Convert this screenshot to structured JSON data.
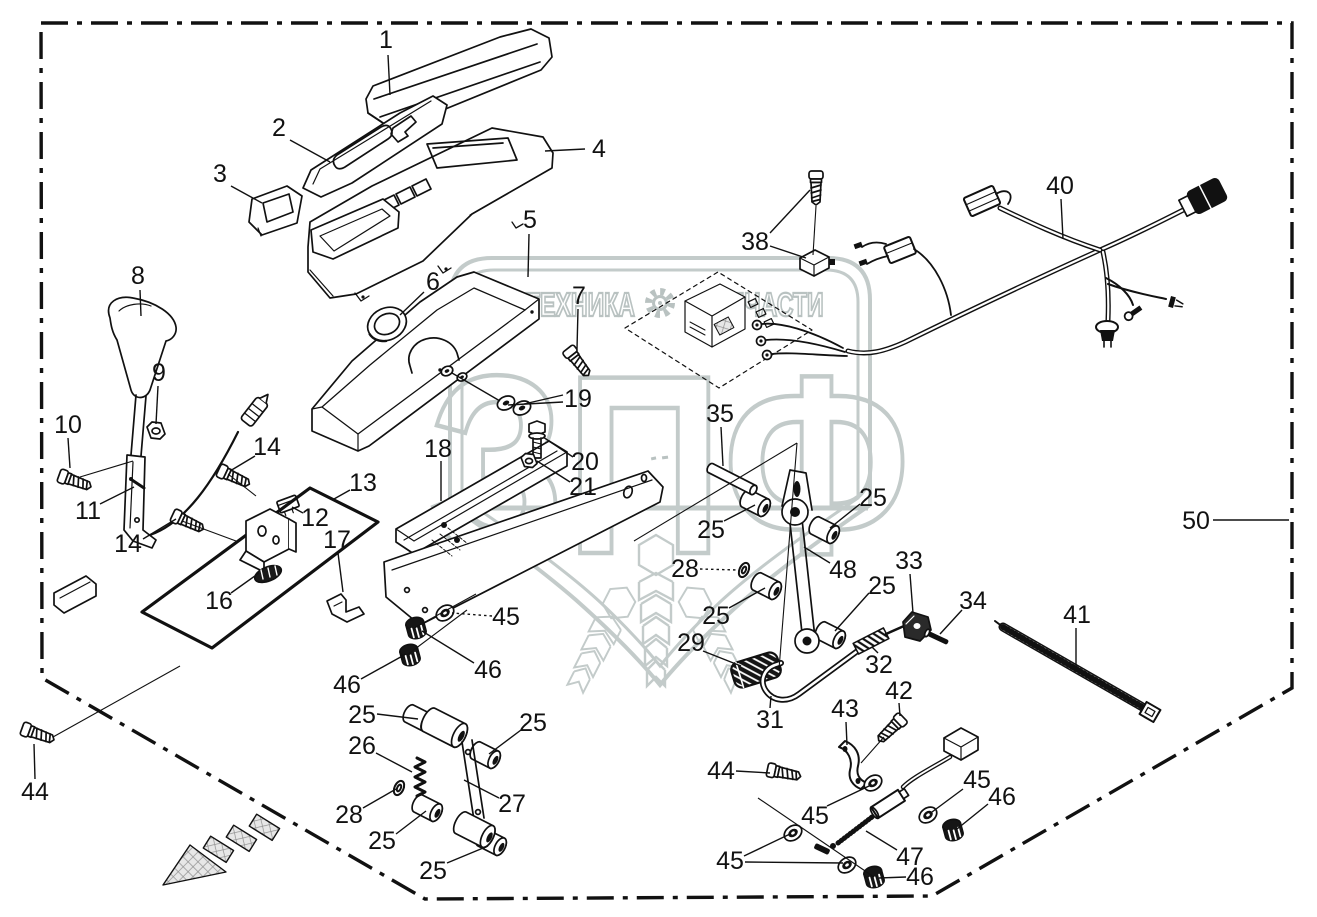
{
  "watermark": {
    "brand_left": "ТЕХНИКА",
    "brand_right": "ЗАПЧАСТИ",
    "logo_letters": "ЗПФ",
    "color": "#c3cbca"
  },
  "frame": {
    "assembly_label": "50"
  },
  "colors": {
    "line": "#111111",
    "background": "#ffffff",
    "watermark": "#c3cbca"
  },
  "callouts": [
    {
      "t": "1",
      "x": 386,
      "y": 40
    },
    {
      "t": "2",
      "x": 279,
      "y": 128
    },
    {
      "t": "3",
      "x": 220,
      "y": 174
    },
    {
      "t": "4",
      "x": 599,
      "y": 149
    },
    {
      "t": "5",
      "x": 530,
      "y": 220
    },
    {
      "t": "6",
      "x": 433,
      "y": 282
    },
    {
      "t": "7",
      "x": 579,
      "y": 296
    },
    {
      "t": "8",
      "x": 138,
      "y": 276
    },
    {
      "t": "9",
      "x": 159,
      "y": 373
    },
    {
      "t": "10",
      "x": 68,
      "y": 425
    },
    {
      "t": "11",
      "x": 88,
      "y": 511
    },
    {
      "t": "12",
      "x": 315,
      "y": 518
    },
    {
      "t": "13",
      "x": 363,
      "y": 483
    },
    {
      "t": "14",
      "x": 267,
      "y": 447
    },
    {
      "t": "14",
      "x": 128,
      "y": 544
    },
    {
      "t": "16",
      "x": 219,
      "y": 601
    },
    {
      "t": "17",
      "x": 337,
      "y": 540
    },
    {
      "t": "18",
      "x": 438,
      "y": 449
    },
    {
      "t": "19",
      "x": 578,
      "y": 399
    },
    {
      "t": "20",
      "x": 585,
      "y": 462
    },
    {
      "t": "21",
      "x": 583,
      "y": 487
    },
    {
      "t": "25",
      "x": 711,
      "y": 530
    },
    {
      "t": "25",
      "x": 873,
      "y": 498
    },
    {
      "t": "25",
      "x": 716,
      "y": 616
    },
    {
      "t": "25",
      "x": 882,
      "y": 586
    },
    {
      "t": "25",
      "x": 362,
      "y": 715
    },
    {
      "t": "25",
      "x": 533,
      "y": 723
    },
    {
      "t": "25",
      "x": 382,
      "y": 841
    },
    {
      "t": "25",
      "x": 433,
      "y": 871
    },
    {
      "t": "26",
      "x": 362,
      "y": 746
    },
    {
      "t": "27",
      "x": 512,
      "y": 804
    },
    {
      "t": "28",
      "x": 685,
      "y": 569
    },
    {
      "t": "28",
      "x": 349,
      "y": 815
    },
    {
      "t": "29",
      "x": 691,
      "y": 643
    },
    {
      "t": "31",
      "x": 770,
      "y": 720
    },
    {
      "t": "32",
      "x": 879,
      "y": 665
    },
    {
      "t": "33",
      "x": 909,
      "y": 561
    },
    {
      "t": "34",
      "x": 973,
      "y": 601
    },
    {
      "t": "35",
      "x": 720,
      "y": 414
    },
    {
      "t": "38",
      "x": 755,
      "y": 242
    },
    {
      "t": "40",
      "x": 1060,
      "y": 186
    },
    {
      "t": "41",
      "x": 1077,
      "y": 615
    },
    {
      "t": "42",
      "x": 899,
      "y": 691
    },
    {
      "t": "43",
      "x": 845,
      "y": 709
    },
    {
      "t": "44",
      "x": 35,
      "y": 792
    },
    {
      "t": "44",
      "x": 721,
      "y": 771
    },
    {
      "t": "45",
      "x": 506,
      "y": 617
    },
    {
      "t": "45",
      "x": 815,
      "y": 816
    },
    {
      "t": "45",
      "x": 977,
      "y": 780
    },
    {
      "t": "45",
      "x": 730,
      "y": 861
    },
    {
      "t": "46",
      "x": 488,
      "y": 670
    },
    {
      "t": "46",
      "x": 347,
      "y": 685
    },
    {
      "t": "46",
      "x": 1002,
      "y": 797
    },
    {
      "t": "46",
      "x": 920,
      "y": 877
    },
    {
      "t": "47",
      "x": 910,
      "y": 857
    },
    {
      "t": "48",
      "x": 843,
      "y": 570
    },
    {
      "t": "50",
      "x": 1196,
      "y": 521
    }
  ],
  "leader_lines": [
    {
      "p": [
        [
          388,
          55
        ],
        [
          390,
          95
        ]
      ]
    },
    {
      "p": [
        [
          290,
          140
        ],
        [
          330,
          162
        ]
      ]
    },
    {
      "p": [
        [
          231,
          186
        ],
        [
          262,
          203
        ]
      ]
    },
    {
      "p": [
        [
          585,
          149
        ],
        [
          545,
          151
        ]
      ]
    },
    {
      "p": [
        [
          529,
          234
        ],
        [
          528,
          277
        ]
      ]
    },
    {
      "p": [
        [
          424,
          292
        ],
        [
          400,
          315
        ]
      ]
    },
    {
      "p": [
        [
          578,
          309
        ],
        [
          577,
          349
        ]
      ]
    },
    {
      "p": [
        [
          140,
          290
        ],
        [
          141,
          316
        ]
      ]
    },
    {
      "p": [
        [
          158,
          386
        ],
        [
          156,
          424
        ]
      ]
    },
    {
      "p": [
        [
          68,
          438
        ],
        [
          70,
          468
        ]
      ]
    },
    {
      "p": [
        [
          100,
          504
        ],
        [
          134,
          487
        ]
      ]
    },
    {
      "p": [
        [
          255,
          456
        ],
        [
          230,
          471
        ]
      ]
    },
    {
      "p": [
        [
          143,
          539
        ],
        [
          176,
          519
        ]
      ]
    },
    {
      "p": [
        [
          303,
          513
        ],
        [
          292,
          507
        ]
      ]
    },
    {
      "p": [
        [
          350,
          490
        ],
        [
          334,
          499
        ]
      ]
    },
    {
      "p": [
        [
          231,
          593
        ],
        [
          259,
          573
        ]
      ]
    },
    {
      "p": [
        [
          338,
          553
        ],
        [
          343,
          592
        ]
      ]
    },
    {
      "p": [
        [
          441,
          461
        ],
        [
          441,
          501
        ]
      ]
    },
    {
      "p": [
        [
          563,
          395
        ],
        [
          524,
          404
        ]
      ]
    },
    {
      "p": [
        [
          563,
          402
        ],
        [
          508,
          405
        ]
      ]
    },
    {
      "p": [
        [
          500,
          401
        ],
        [
          452,
          373
        ]
      ]
    },
    {
      "p": [
        [
          573,
          457
        ],
        [
          543,
          437
        ]
      ]
    },
    {
      "p": [
        [
          570,
          482
        ],
        [
          537,
          461
        ]
      ]
    },
    {
      "p": [
        [
          724,
          521
        ],
        [
          755,
          505
        ]
      ]
    },
    {
      "p": [
        [
          860,
          504
        ],
        [
          830,
          528
        ]
      ]
    },
    {
      "p": [
        [
          729,
          608
        ],
        [
          765,
          588
        ]
      ]
    },
    {
      "p": [
        [
          869,
          593
        ],
        [
          835,
          631
        ]
      ]
    },
    {
      "p": [
        [
          377,
          714
        ],
        [
          418,
          719
        ]
      ]
    },
    {
      "p": [
        [
          521,
          730
        ],
        [
          489,
          754
        ]
      ]
    },
    {
      "p": [
        [
          396,
          834
        ],
        [
          426,
          811
        ]
      ]
    },
    {
      "p": [
        [
          447,
          863
        ],
        [
          488,
          846
        ]
      ]
    },
    {
      "p": [
        [
          376,
          753
        ],
        [
          412,
          772
        ]
      ]
    },
    {
      "p": [
        [
          499,
          798
        ],
        [
          464,
          780
        ]
      ]
    },
    {
      "p": [
        [
          700,
          569
        ],
        [
          738,
          570
        ]
      ],
      "d": true
    },
    {
      "p": [
        [
          363,
          808
        ],
        [
          396,
          789
        ]
      ]
    },
    {
      "p": [
        [
          703,
          651
        ],
        [
          741,
          666
        ]
      ]
    },
    {
      "p": [
        [
          770,
          708
        ],
        [
          771,
          696
        ]
      ]
    },
    {
      "p": [
        [
          878,
          653
        ],
        [
          872,
          647
        ]
      ]
    },
    {
      "p": [
        [
          910,
          574
        ],
        [
          913,
          613
        ]
      ]
    },
    {
      "p": [
        [
          962,
          610
        ],
        [
          940,
          634
        ]
      ]
    },
    {
      "p": [
        [
          721,
          427
        ],
        [
          723,
          466
        ]
      ]
    },
    {
      "p": [
        [
          770,
          233
        ],
        [
          810,
          190
        ]
      ]
    },
    {
      "p": [
        [
          770,
          246
        ],
        [
          806,
          258
        ]
      ]
    },
    {
      "p": [
        [
          1061,
          199
        ],
        [
          1063,
          239
        ]
      ]
    },
    {
      "p": [
        [
          1076,
          628
        ],
        [
          1076,
          666
        ]
      ]
    },
    {
      "p": [
        [
          899,
          703
        ],
        [
          900,
          716
        ]
      ]
    },
    {
      "p": [
        [
          846,
          722
        ],
        [
          847,
          745
        ]
      ]
    },
    {
      "p": [
        [
          35,
          779
        ],
        [
          34,
          744
        ]
      ]
    },
    {
      "p": [
        [
          736,
          771
        ],
        [
          770,
          773
        ]
      ]
    },
    {
      "p": [
        [
          492,
          616
        ],
        [
          452,
          613
        ]
      ],
      "d": true
    },
    {
      "p": [
        [
          827,
          806
        ],
        [
          869,
          786
        ]
      ]
    },
    {
      "p": [
        [
          963,
          789
        ],
        [
          932,
          812
        ]
      ]
    },
    {
      "p": [
        [
          744,
          856
        ],
        [
          790,
          834
        ]
      ]
    },
    {
      "p": [
        [
          745,
          862
        ],
        [
          843,
          863
        ]
      ]
    },
    {
      "p": [
        [
          474,
          663
        ],
        [
          422,
          631
        ]
      ]
    },
    {
      "p": [
        [
          361,
          679
        ],
        [
          406,
          654
        ]
      ]
    },
    {
      "p": [
        [
          988,
          804
        ],
        [
          957,
          829
        ]
      ]
    },
    {
      "p": [
        [
          906,
          877
        ],
        [
          879,
          878
        ]
      ]
    },
    {
      "p": [
        [
          897,
          850
        ],
        [
          866,
          831
        ]
      ]
    },
    {
      "p": [
        [
          830,
          563
        ],
        [
          804,
          547
        ]
      ]
    },
    {
      "p": [
        [
          1213,
          520
        ],
        [
          1289,
          520
        ]
      ]
    }
  ],
  "aux_lines": [
    [
      [
        53,
        737
      ],
      [
        180,
        666
      ]
    ],
    [
      [
        80,
        477
      ],
      [
        133,
        461
      ]
    ],
    [
      [
        228,
        474
      ],
      [
        256,
        496
      ]
    ],
    [
      [
        182,
        521
      ],
      [
        236,
        541
      ]
    ],
    [
      [
        797,
        443
      ],
      [
        634,
        541
      ]
    ],
    [
      [
        797,
        443
      ],
      [
        779,
        669
      ]
    ],
    [
      [
        476,
        594
      ],
      [
        414,
        628
      ]
    ],
    [
      [
        467,
        610
      ],
      [
        407,
        655
      ]
    ],
    [
      [
        758,
        798
      ],
      [
        874,
        877
      ]
    ],
    [
      [
        884,
        737
      ],
      [
        861,
        763
      ]
    ],
    [
      [
        816,
        206
      ],
      [
        813,
        255
      ]
    ]
  ]
}
